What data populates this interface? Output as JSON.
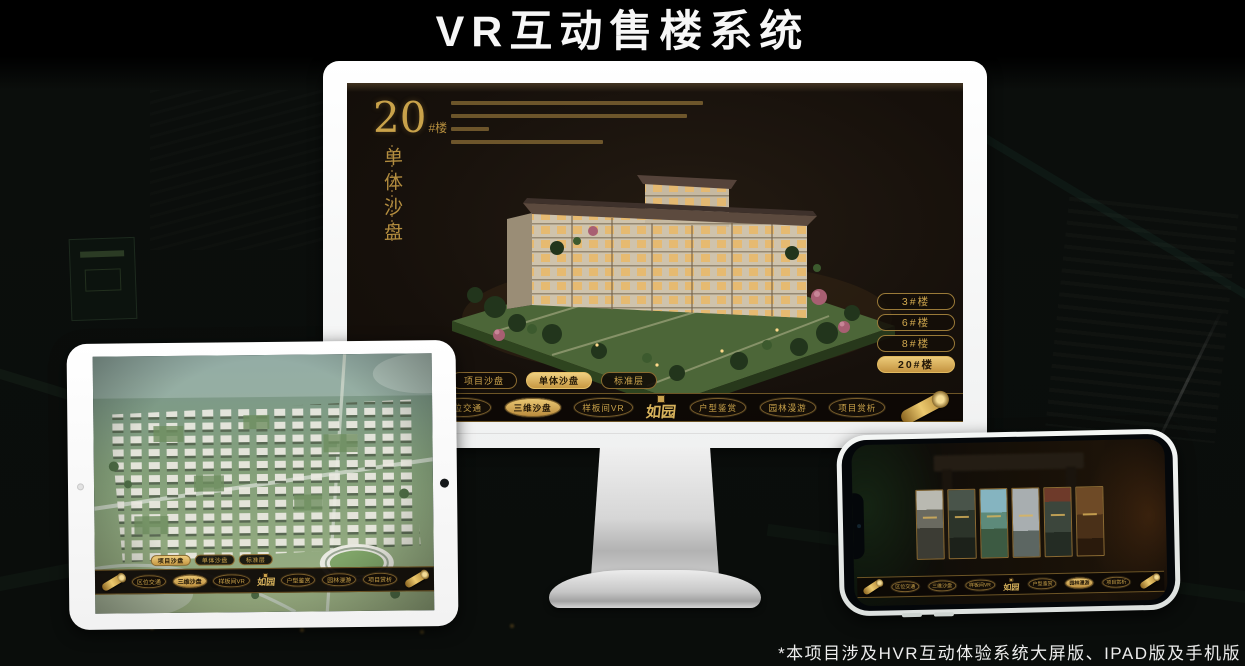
{
  "page": {
    "title": "VR互动售楼系统",
    "footnote": "*本项目涉及HVR互动体验系统大屏版、IPAD版及手机版"
  },
  "screen": {
    "heading": {
      "number": "20",
      "suffix": "#楼",
      "vertical": "单体沙盘"
    },
    "floors": [
      "3#楼",
      "6#楼",
      "8#楼",
      "20#楼"
    ],
    "active_floor": "20#楼",
    "tabs": [
      "项目沙盘",
      "单体沙盘",
      "标准层"
    ],
    "desktop_active_tab": "单体沙盘",
    "tablet_active_tab": "项目沙盘"
  },
  "menu": {
    "logo": "如园",
    "items": [
      "区位交通",
      "三维沙盘",
      "样板间VR",
      "户型鉴赏",
      "园林漫游",
      "项目赏析"
    ],
    "desktop_active": "三维沙盘",
    "tablet_active": "三维沙盘",
    "phone_active": "园林漫游"
  },
  "colors": {
    "gold": "#c9a24a",
    "gold_bright": "#ecca76",
    "screen_bg": "#16100b",
    "active_text": "#1d1306",
    "title_text": "#f7f7f7"
  }
}
